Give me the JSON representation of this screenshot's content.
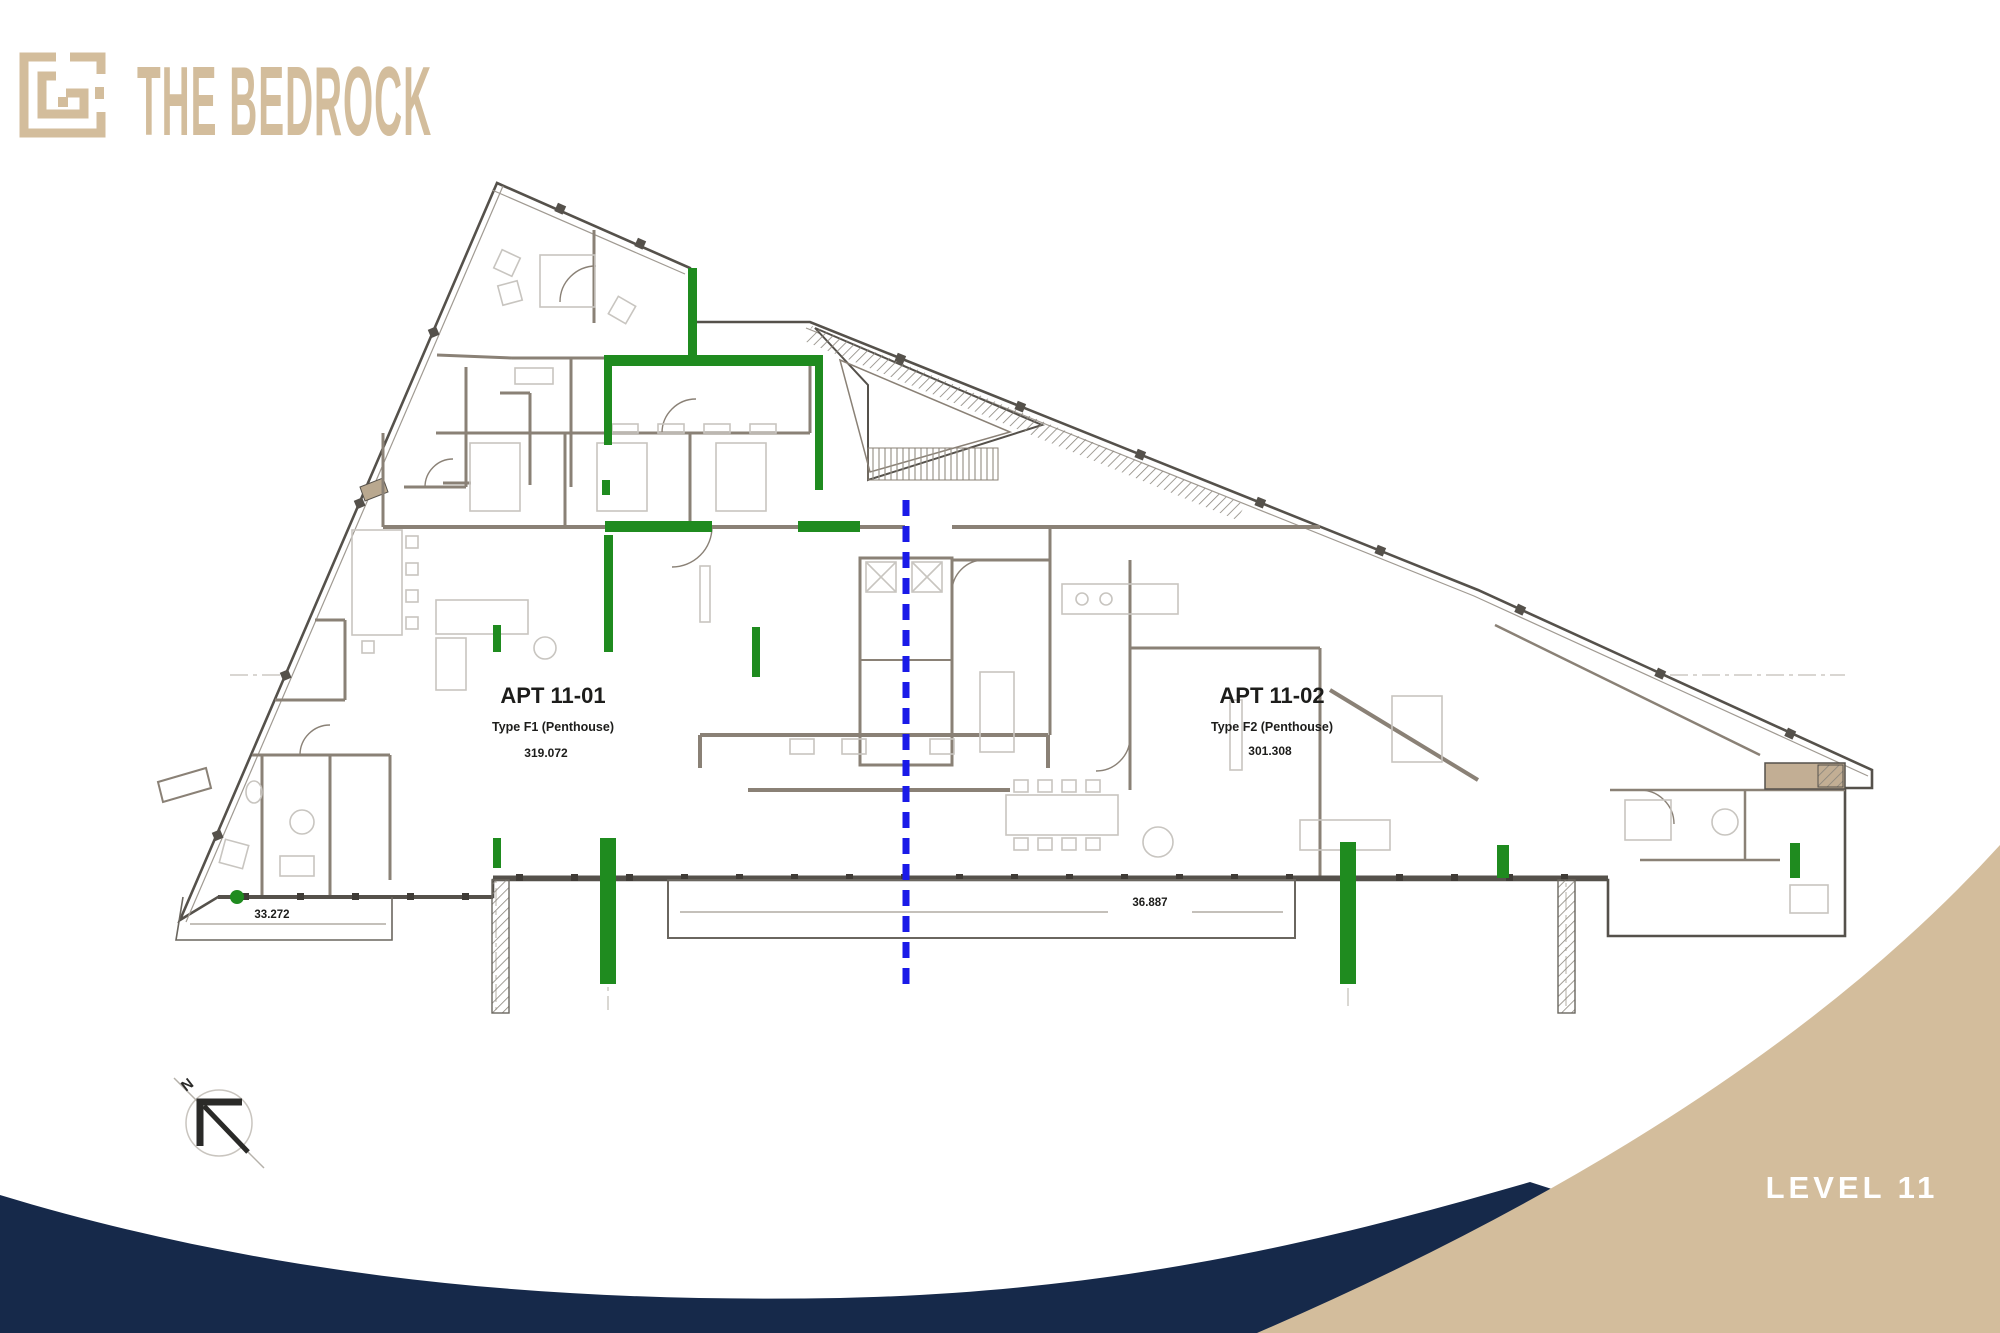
{
  "brand": {
    "name": "THE BEDROCK"
  },
  "plan": {
    "apartments": [
      {
        "id": "APT 11-01",
        "type": "Type F1 (Penthouse)",
        "area": "319.072"
      },
      {
        "id": "APT 11-02",
        "type": "Type F2 (Penthouse)",
        "area": "301.308"
      }
    ],
    "dimensions": {
      "left": "33.272",
      "bottom": "36.887"
    },
    "compass": {
      "label": "N"
    }
  },
  "footer": {
    "level_label": "LEVEL 11"
  },
  "colors": {
    "tan": "#d3bd9c",
    "tan_dark": "#c2ae94",
    "navy": "#16294a",
    "green": "#1f8b1f",
    "blue": "#1a1ae8",
    "wall_dark": "#55514b",
    "wall_brown": "#8a8176",
    "wall_light": "#a09a92",
    "furniture": "#c8c5c0",
    "text_dark": "#1d1d1b"
  }
}
